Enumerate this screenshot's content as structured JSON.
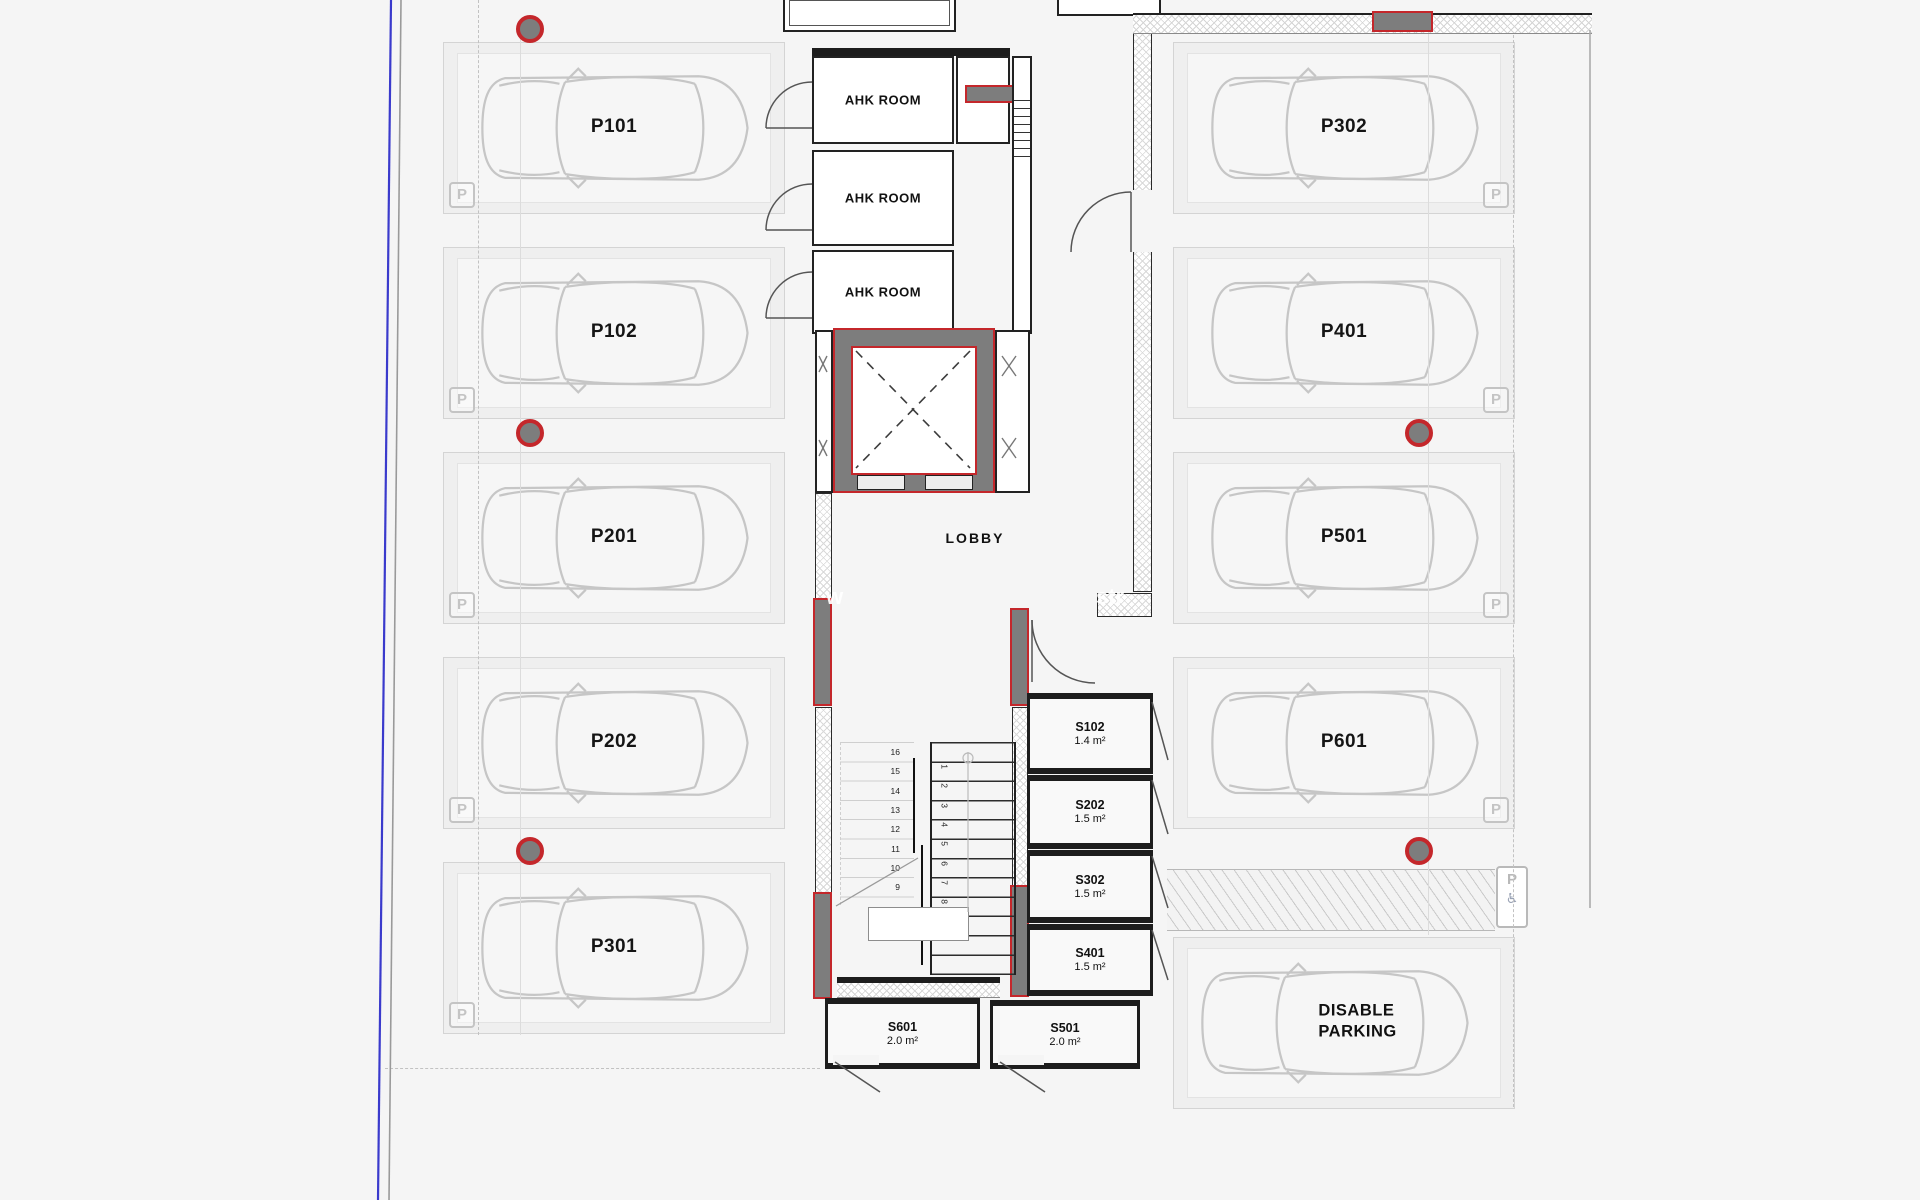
{
  "plan": {
    "lobby_label": "LOBBY",
    "parking_sign": "P",
    "ahk_rooms": [
      {
        "label": "AHK ROOM"
      },
      {
        "label": "AHK ROOM"
      },
      {
        "label": "AHK ROOM"
      }
    ],
    "parking_left": [
      {
        "label": "P101"
      },
      {
        "label": "P102"
      },
      {
        "label": "P201"
      },
      {
        "label": "P202"
      },
      {
        "label": "P301"
      }
    ],
    "parking_right": [
      {
        "label": "P302"
      },
      {
        "label": "P401"
      },
      {
        "label": "P501"
      },
      {
        "label": "P601"
      }
    ],
    "disabled_stall": {
      "line1": "DISABLE",
      "line2": "PARKING"
    },
    "disabled_sign": {
      "p": "P",
      "wheelchair": "♿"
    },
    "storage_side": [
      {
        "label": "S102",
        "area": "1.4 m²"
      },
      {
        "label": "S202",
        "area": "1.5 m²"
      },
      {
        "label": "S302",
        "area": "1.5 m²"
      },
      {
        "label": "S401",
        "area": "1.5 m²"
      }
    ],
    "storage_bottom": [
      {
        "label": "S601",
        "area": "2.0 m²"
      },
      {
        "label": "S501",
        "area": "2.0 m²"
      }
    ],
    "stairs": {
      "left_numbers": [
        "16",
        "15",
        "14",
        "13",
        "12",
        "11",
        "10",
        "9"
      ],
      "right_numbers": [
        "1",
        "2",
        "3",
        "4",
        "5",
        "6",
        "7",
        "8"
      ]
    },
    "watermark": {
      "left": "w",
      "right": "str"
    },
    "colors": {
      "accent_red": "#c4272b",
      "pier_gray": "#7d7d7d",
      "wall_black": "#1d1d1d",
      "boundary_blue": "#3a3acc",
      "line_gray": "#c6c6c6"
    }
  }
}
